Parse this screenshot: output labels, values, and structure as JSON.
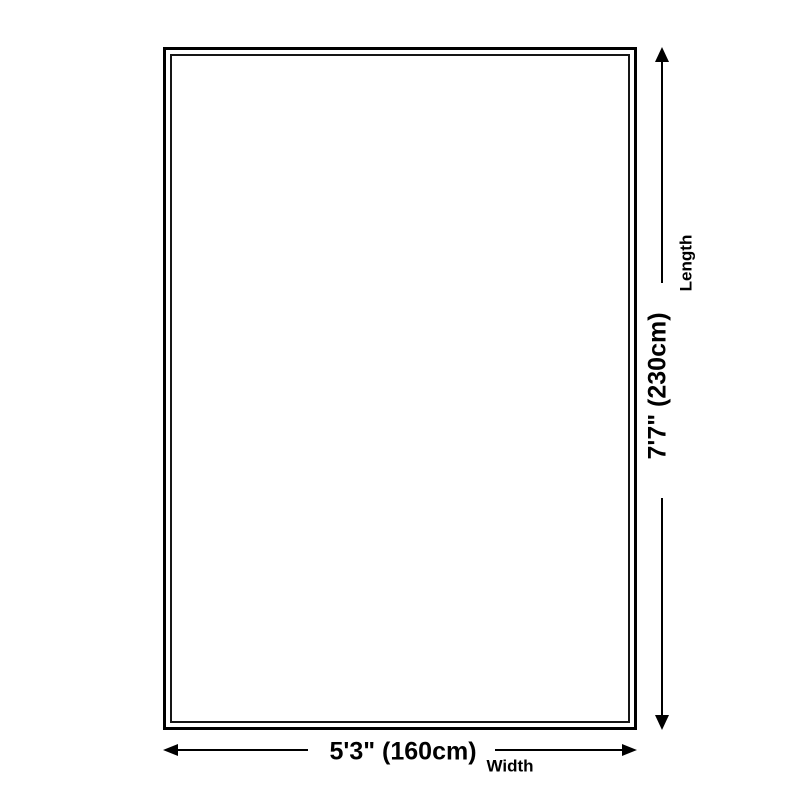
{
  "colors": {
    "line": "#000000",
    "inner_border": "#161616",
    "background": "#ffffff"
  },
  "diagram": {
    "length_dimension": {
      "value": "7'7\" (230cm)",
      "label": "Length"
    },
    "width_dimension": {
      "value": "5'3\" (160cm)",
      "label": "Width"
    },
    "icons": {
      "arrow_up": "arrow-up-icon",
      "arrow_down": "arrow-down-icon",
      "arrow_left": "arrow-left-icon",
      "arrow_right": "arrow-right-icon"
    }
  }
}
